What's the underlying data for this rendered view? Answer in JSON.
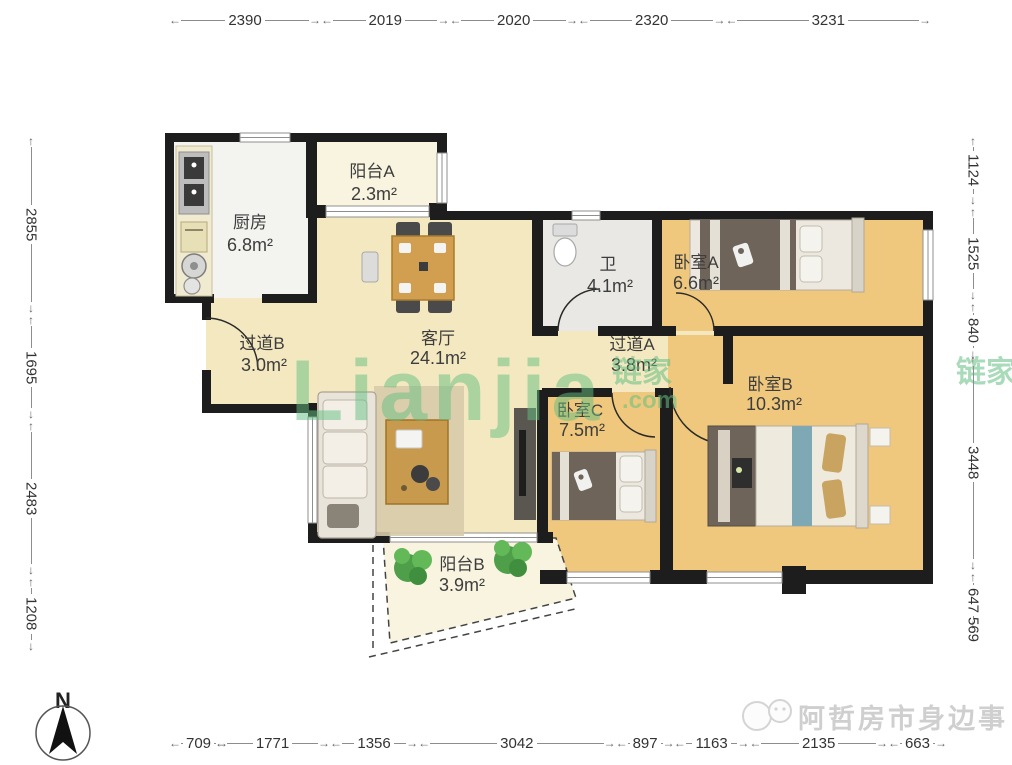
{
  "plan": {
    "rooms": [
      {
        "id": "kitchen",
        "name": "厨房",
        "area": "6.8m²"
      },
      {
        "id": "balcony-a",
        "name": "阳台A",
        "area": "2.3m²"
      },
      {
        "id": "bathroom",
        "name": "卫",
        "area": "4.1m²"
      },
      {
        "id": "bedroom-a",
        "name": "卧室A",
        "area": "6.6m²"
      },
      {
        "id": "hallway-b",
        "name": "过道B",
        "area": "3.0m²"
      },
      {
        "id": "living-room",
        "name": "客厅",
        "area": "24.1m²"
      },
      {
        "id": "hallway-a",
        "name": "过道A",
        "area": "3.8m²"
      },
      {
        "id": "bedroom-b",
        "name": "卧室B",
        "area": "10.3m²"
      },
      {
        "id": "bedroom-c",
        "name": "卧室C",
        "area": "7.5m²"
      },
      {
        "id": "balcony-b",
        "name": "阳台B",
        "area": "3.9m²"
      }
    ]
  },
  "rulers": {
    "top": [
      "2390",
      "2019",
      "2020",
      "2320",
      "3231"
    ],
    "left": [
      "2855",
      "1695",
      "2483",
      "1208"
    ],
    "right": [
      "1124",
      "1525",
      "840",
      "3448",
      "647",
      "569"
    ],
    "bottom": [
      "709",
      "1771",
      "1356",
      "3042",
      "897",
      "1163",
      "2135",
      "663"
    ]
  },
  "compass": {
    "north_label": "N"
  },
  "watermark": {
    "brand": "Lianjia",
    "brand_cn": "链家",
    "brand_suffix": ".com"
  },
  "credit": {
    "text": "阿哲房市身边事"
  },
  "colors": {
    "wall": "#1d1d1d",
    "living_floor": "#f4e8c0",
    "bedroom_floor": "#f0c87d",
    "kitchen_floor": "#f3f3f0",
    "bath_floor": "#e9e8e4",
    "balcony_floor": "#f8f4e0",
    "watermark_green": "#64bf82",
    "dimension_text": "#333333"
  }
}
